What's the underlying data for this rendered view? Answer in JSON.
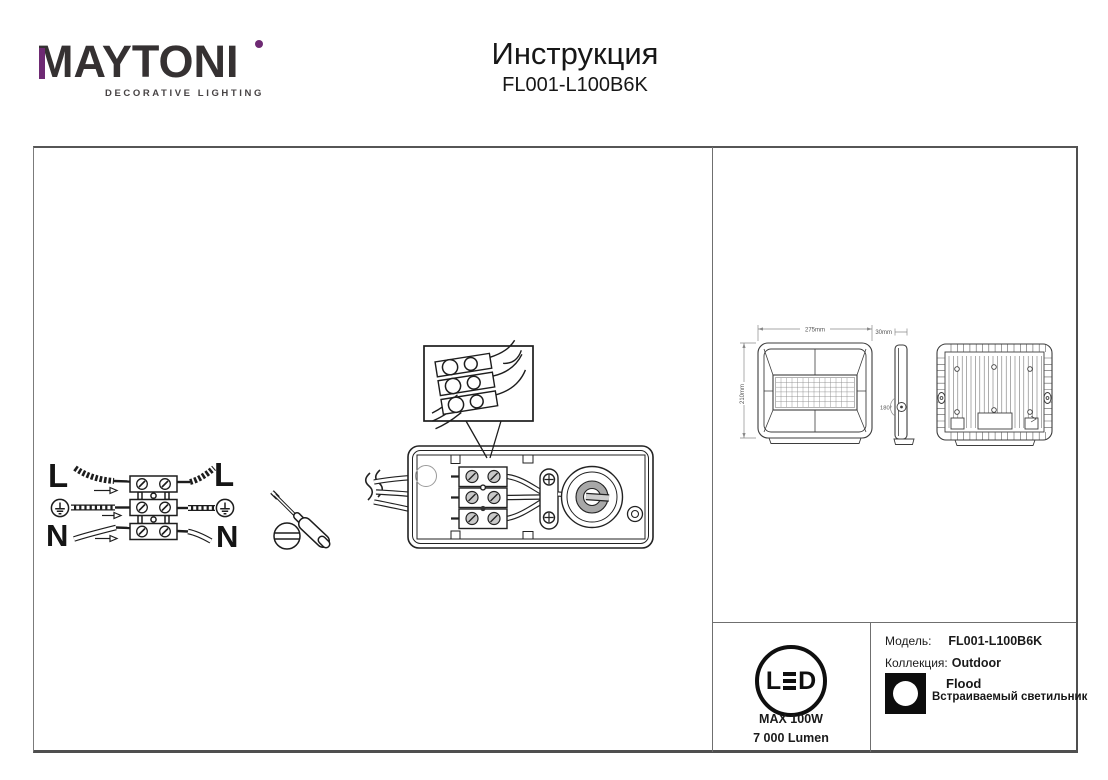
{
  "brand": {
    "name": "MAYTONI",
    "tagline": "DECORATIVE LIGHTING",
    "accent_color": "#6e2a73"
  },
  "header": {
    "title": "Инструкция",
    "model": "FL001-L100B6K"
  },
  "wiring": {
    "line": "L",
    "neutral": "N"
  },
  "dimensions": {
    "width": "275mm",
    "height": "210mm",
    "depth": "30mm",
    "angle": "180°"
  },
  "badge": {
    "led_l": "L",
    "led_d": "D",
    "max_power": "MAX 100W",
    "luminous_flux": "7 000 Lumen"
  },
  "product": {
    "model_label": "Модель:",
    "model": "FL001-L100B6K",
    "collection_label": "Коллекция:",
    "collection": "Outdoor",
    "type": "Flood",
    "description": "Встраиваемый светильник"
  }
}
